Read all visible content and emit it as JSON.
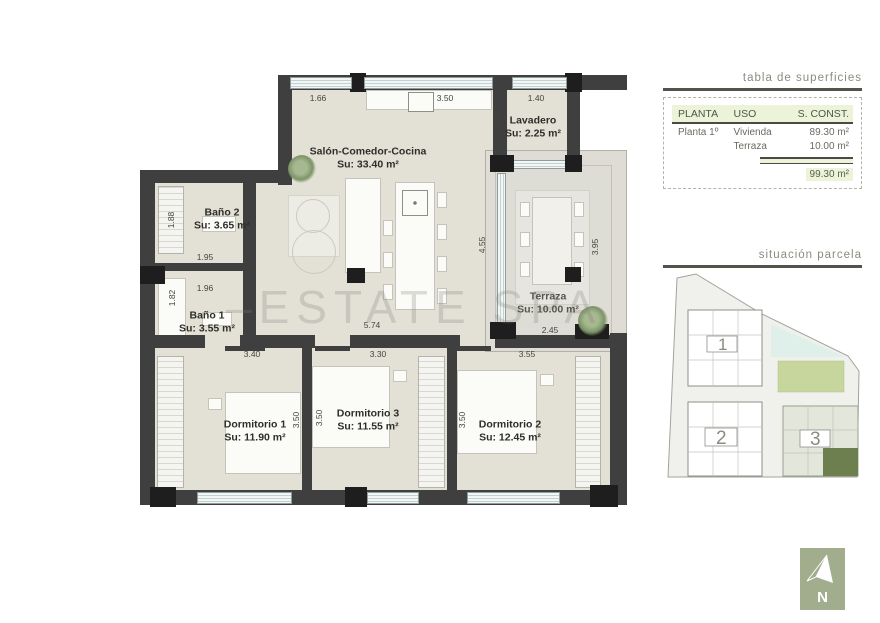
{
  "titles": {
    "surfaces": "tabla de superficies",
    "site": "situación parcela"
  },
  "surfaces_table": {
    "headers": [
      "PLANTA",
      "USO",
      "S. CONST."
    ],
    "rows": [
      {
        "planta": "Planta 1º",
        "uso": "Vivienda",
        "sconst": "89.30 m²"
      },
      {
        "planta": "",
        "uso": "Terraza",
        "sconst": "10.00 m²"
      }
    ],
    "total": "99.30 m²"
  },
  "plan": {
    "watermark": "–ESTATE SPA",
    "rooms": {
      "salon": {
        "name": "Salón-Comedor-Cocina",
        "area": "Su: 33.40 m²"
      },
      "lavadero": {
        "name": "Lavadero",
        "area": "Su: 2.25 m²"
      },
      "bano2": {
        "name": "Baño 2",
        "area": "Su: 3.65 m²"
      },
      "bano1": {
        "name": "Baño 1",
        "area": "Su: 3.55 m²"
      },
      "terraza": {
        "name": "Terraza",
        "area": "Su: 10.00 m²"
      },
      "dorm1": {
        "name": "Dormitorio 1",
        "area": "Su: 11.90 m²"
      },
      "dorm3": {
        "name": "Dormitorio 3",
        "area": "Su: 11.55 m²"
      },
      "dorm2": {
        "name": "Dormitorio 2",
        "area": "Su: 12.45 m²"
      }
    },
    "dims": {
      "top_left": "1.66",
      "top_mid": "3.50",
      "top_right": "1.40",
      "lav_h": "1.50",
      "bano2_h": "1.88",
      "bano2_w": "1.95",
      "bano1_w": "1.96",
      "bano1_h": "1.82",
      "hall": "5.74",
      "terr_left": "4.55",
      "terr_right": "3.95",
      "terr_w": "2.45",
      "dorm1_w": "3.40",
      "dorm3_w": "3.30",
      "dorm2_w": "3.55",
      "dorm1_h": "3.50",
      "dorm3_h": "3.50",
      "dorm2_h": "3.50"
    }
  },
  "site_plan": {
    "building1": "1",
    "building2": "2",
    "building3": "3"
  },
  "compass": {
    "north": "N"
  },
  "colors": {
    "wall": "#3f3f3f",
    "floor": "#e3e0d6",
    "table_header_bg": "#edf3d8",
    "pool_green": "#c6d69d",
    "water_cyan": "#def0e9",
    "unit_highlight": "#6d7f4e",
    "compass_bg": "#a2ad8d"
  }
}
